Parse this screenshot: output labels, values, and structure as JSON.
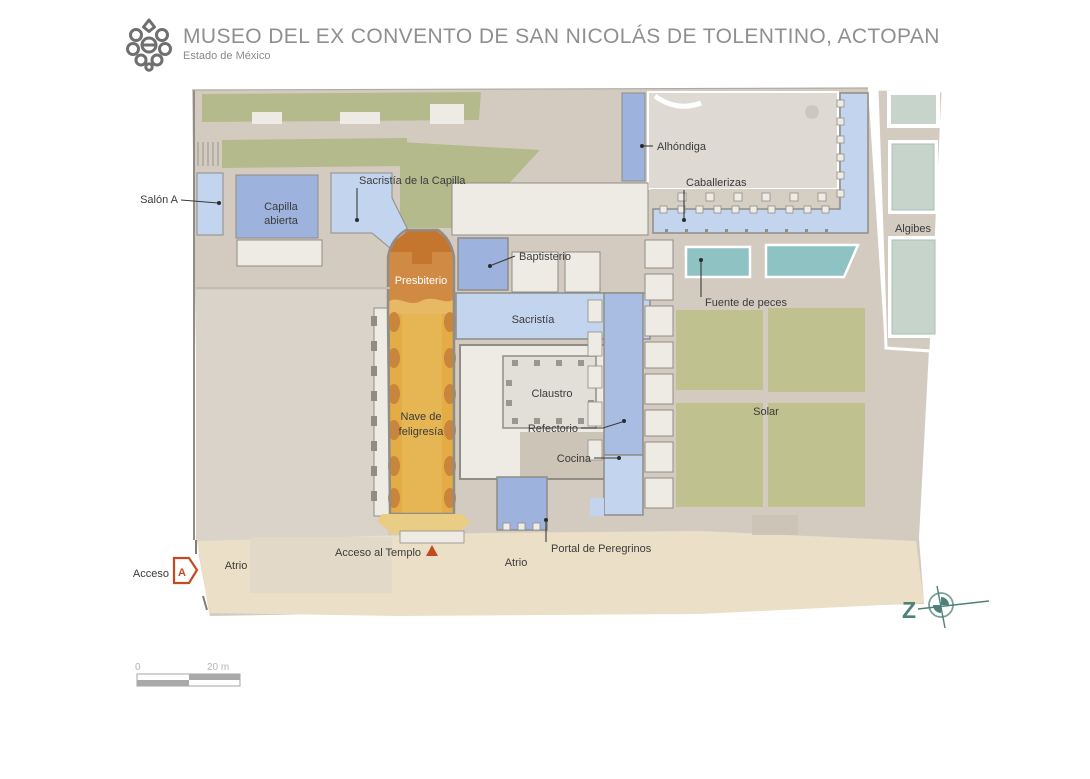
{
  "header": {
    "title": "MUSEO DEL EX CONVENTO DE SAN NICOLÁS DE TOLENTINO, ACTOPAN",
    "subtitle": "Estado de México"
  },
  "map": {
    "labels": {
      "salon_a": "Salón A",
      "capilla_abierta_1": "Capilla",
      "capilla_abierta_2": "abierta",
      "sacristia_capilla": "Sacristía de la Capilla",
      "presbiterio": "Presbiterio",
      "nave_1": "Nave de",
      "nave_2": "feligresía",
      "baptisterio": "Baptisterio",
      "sacristia": "Sacristía",
      "claustro": "Claustro",
      "refectorio": "Refectorio",
      "cocina": "Cocina",
      "alhondiga": "Alhóndiga",
      "caballerizas": "Caballerizas",
      "fuente_peces": "Fuente de peces",
      "solar": "Solar",
      "algibes": "Algibes",
      "portal_peregrinos": "Portal de Peregrinos",
      "atrio_left": "Atrio",
      "atrio_right": "Atrio",
      "acceso": "Acceso",
      "acceso_templo": "Acceso al Templo"
    },
    "annotations": {
      "acceso_letter": "A",
      "north_letter": "Z"
    },
    "scale": {
      "start": "0",
      "end": "20 m"
    },
    "colors": {
      "base": "#d3cbc0",
      "west_court": "#dad3c9",
      "atrio": "#ecdfc8",
      "atrio_patch": "#e2d9c9",
      "green": "#b4ba8c",
      "courtyard": "#dedad3",
      "claustro_patio": "#e2dfd8",
      "room_white": "#eeebe4",
      "tan_room": "#ccc5b7",
      "tan_band": "#d5cec2",
      "blue_medium": "#9db3dd",
      "blue_light": "#c3d5ee",
      "blue_corridor": "#a9bde3",
      "nave_gold": "#e3ac44",
      "nave_gold_light": "#eabf63",
      "church_apron": "#e9cd85",
      "presbiterio_orange": "#d08a44",
      "presbiterio_dark": "#c4762e",
      "transition_band": "#e8b964",
      "pilaster": "#c8853b",
      "pool_teal": "#8fc3c3",
      "algibe_teal": "#c6d4cc",
      "solar_olive": "#bfc28e",
      "wall_gray": "#8f8d86",
      "column_gray": "#9b978e",
      "accent_red": "#c44a22",
      "compass_teal": "#4e8177",
      "logo_gray": "#6f6f6f"
    }
  }
}
